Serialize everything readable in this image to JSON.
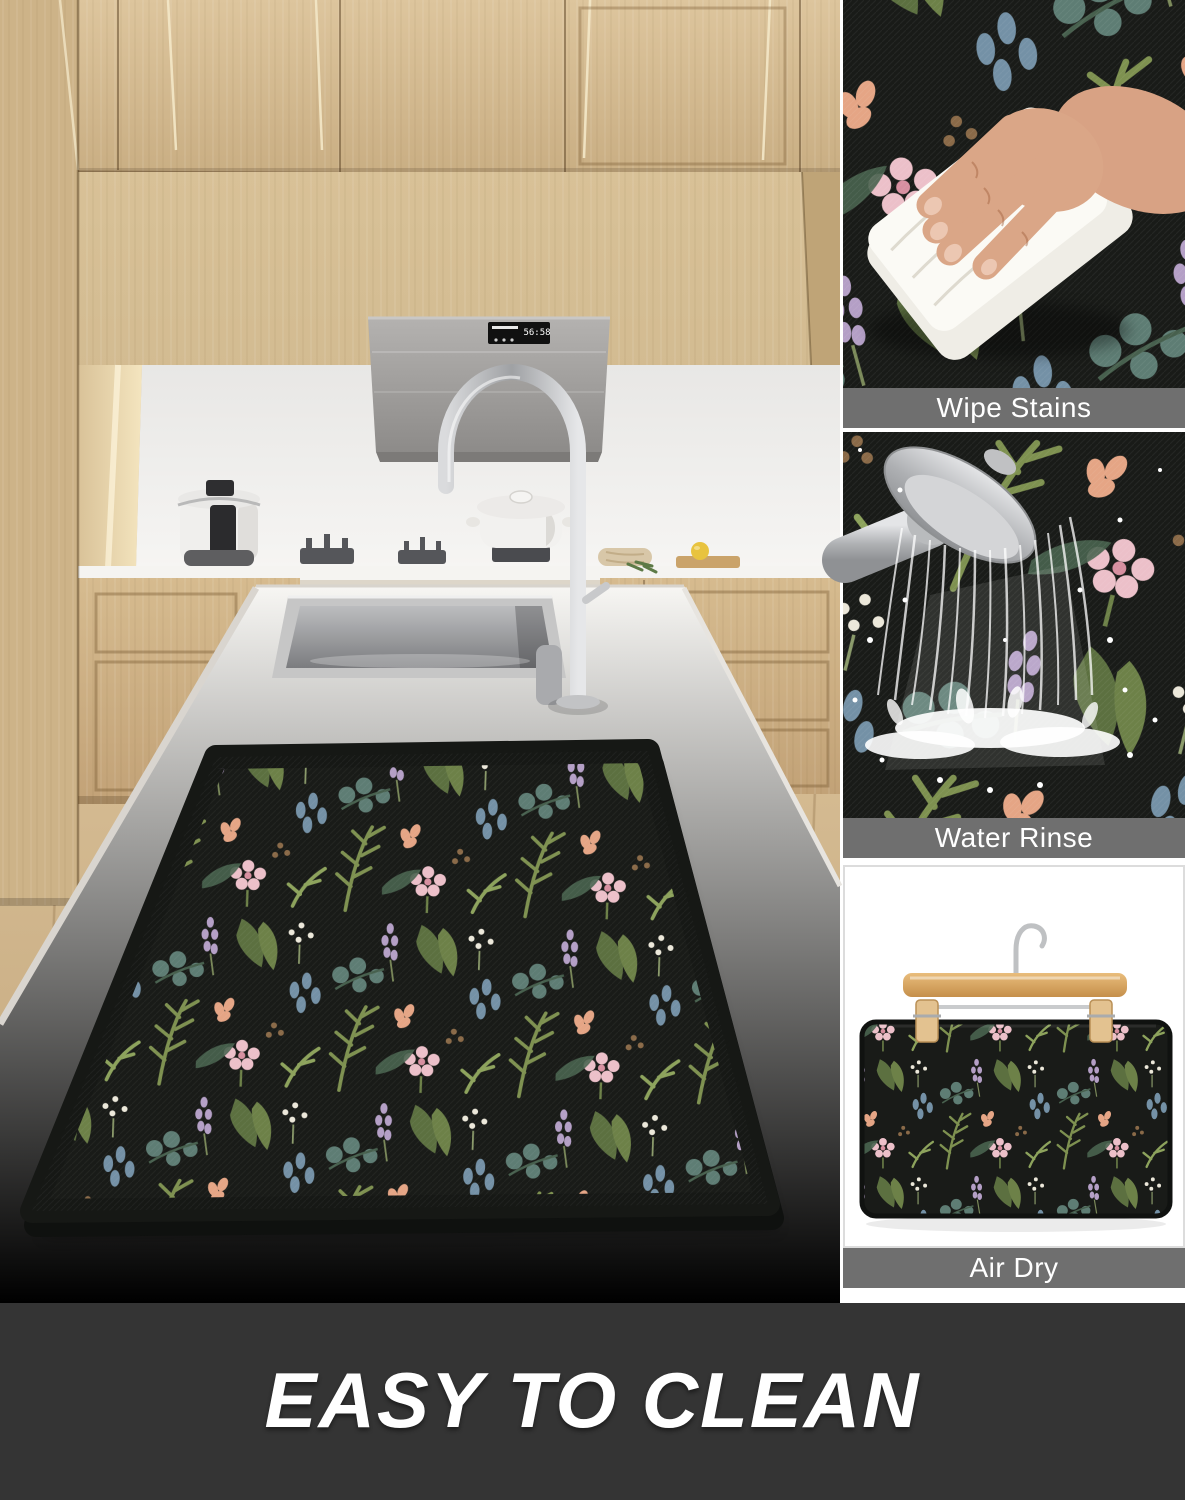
{
  "panels": [
    {
      "label": "Wipe Stains"
    },
    {
      "label": "Water Rinse"
    },
    {
      "label": "Air Dry"
    }
  ],
  "banner": {
    "label": "EASY TO CLEAN"
  },
  "hood": {
    "display": "56:58"
  },
  "colors": {
    "label_bar_bg": "#6f6f6f",
    "label_bar_text": "#ffffff",
    "banner_bg": "#343434",
    "banner_text": "#ffffff",
    "mat_background": "#191b18",
    "cabinet_wood": "#d4ba90",
    "countertop_white": "#f4f3f0",
    "hood_gray": "#a3a19f",
    "floor_wood": "#cdb289",
    "foliage_green": "#7e9150",
    "foliage_teal": "#5e7d74",
    "flower_pink": "#ecc0c9",
    "flower_white": "#ece8da",
    "flower_lavender": "#b49fc6",
    "skin_tone": "#d8a284"
  }
}
